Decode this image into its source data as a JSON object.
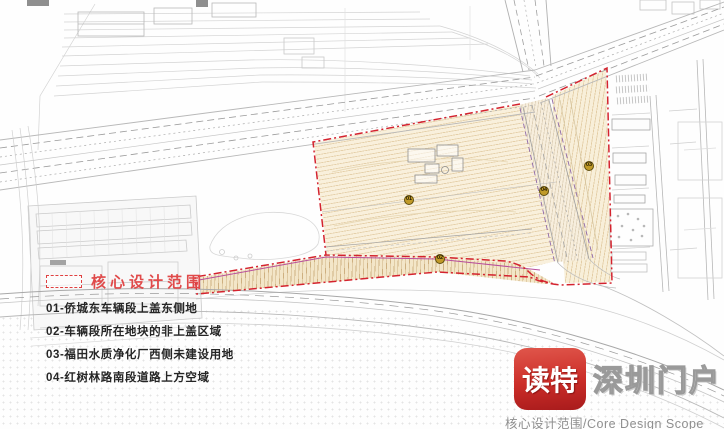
{
  "legend": {
    "title": "核心设计范围",
    "items": [
      {
        "label": "01-侨城东车辆段上盖东侧地"
      },
      {
        "label": "02-车辆段所在地块的非上盖区域"
      },
      {
        "label": "03-福田水质净化厂西侧未建设用地"
      },
      {
        "label": "04-红树林路南段道路上方空域"
      }
    ]
  },
  "markers": [
    {
      "label": "01"
    },
    {
      "label": "02"
    },
    {
      "label": "03"
    },
    {
      "label": "04"
    }
  ],
  "watermark": {
    "app_name": "读特",
    "site_name": "深圳门户",
    "caption": "核心设计范围/Core Design Scope"
  },
  "colors": {
    "scope_boundary_red": "#d4232e",
    "parcel_beige": "#f9f0dc",
    "strip_beige": "#f3e6c8",
    "marker_olive": "#c09a28",
    "legend_title_red": "#e04a4a",
    "logo_red": "#cb2d28",
    "magenta_accent": "#b84f9c",
    "purple_road_edge": "#8e68a8",
    "cad_line_gray": "#b8b8b8"
  }
}
